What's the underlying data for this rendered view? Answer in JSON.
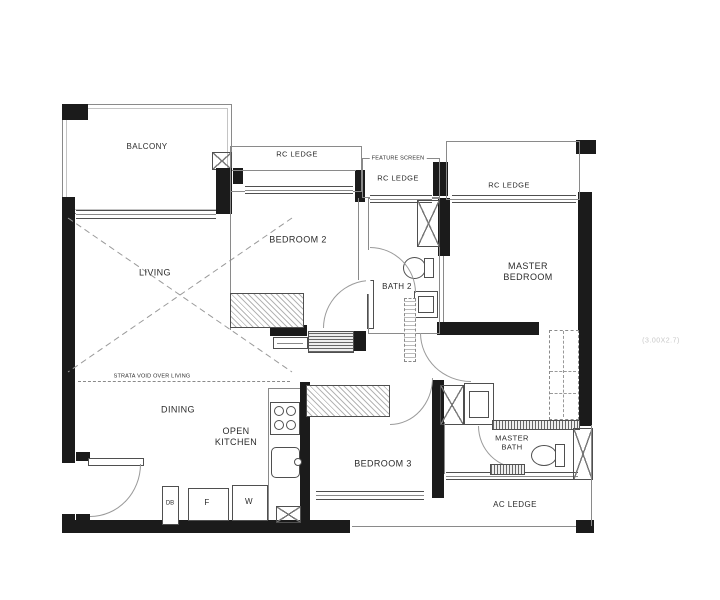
{
  "rooms": {
    "balcony": "BALCONY",
    "living": "LIVING",
    "dining": "DINING",
    "open_kitchen": "OPEN\nKITCHEN",
    "bedroom2": "BEDROOM 2",
    "bath2": "BATH 2",
    "master_bedroom": "MASTER\nBEDROOM",
    "bedroom3": "BEDROOM 3",
    "master_bath": "MASTER\nBATH"
  },
  "ledges": {
    "rc_ledge_left": "RC LEDGE",
    "rc_ledge_center": "RC LEDGE",
    "rc_ledge_right": "RC LEDGE",
    "ac_ledge": "AC LEDGE"
  },
  "annotations": {
    "feature_screen": "FEATURE SCREEN",
    "strata_void": "STRATA VOID OVER LIVING",
    "watermark": "(3.00X2.7)"
  },
  "appliances": {
    "db": "DB",
    "fridge": "F",
    "washer": "W"
  },
  "icons": {
    "shower-icon": "x-cross-box",
    "ac-unit-icon": "x-cross-box",
    "vent-icon": "x-cross-box",
    "toilet-icon": "ellipse-with-tank",
    "sink-icon": "inset-square",
    "stove-icon": "four-burner-circles",
    "wardrobe-icon": "hatched-box",
    "door-swing-icon": "quarter-arc",
    "window-icon": "triple-line"
  },
  "colors": {
    "wall": "#1b1b1b",
    "line": "#8a8a8a",
    "line_dark": "#4f4f4f",
    "line_light": "#c4c4c4",
    "text": "#2b2b2b",
    "background": "#ffffff",
    "watermark": "#c8c8c8"
  }
}
